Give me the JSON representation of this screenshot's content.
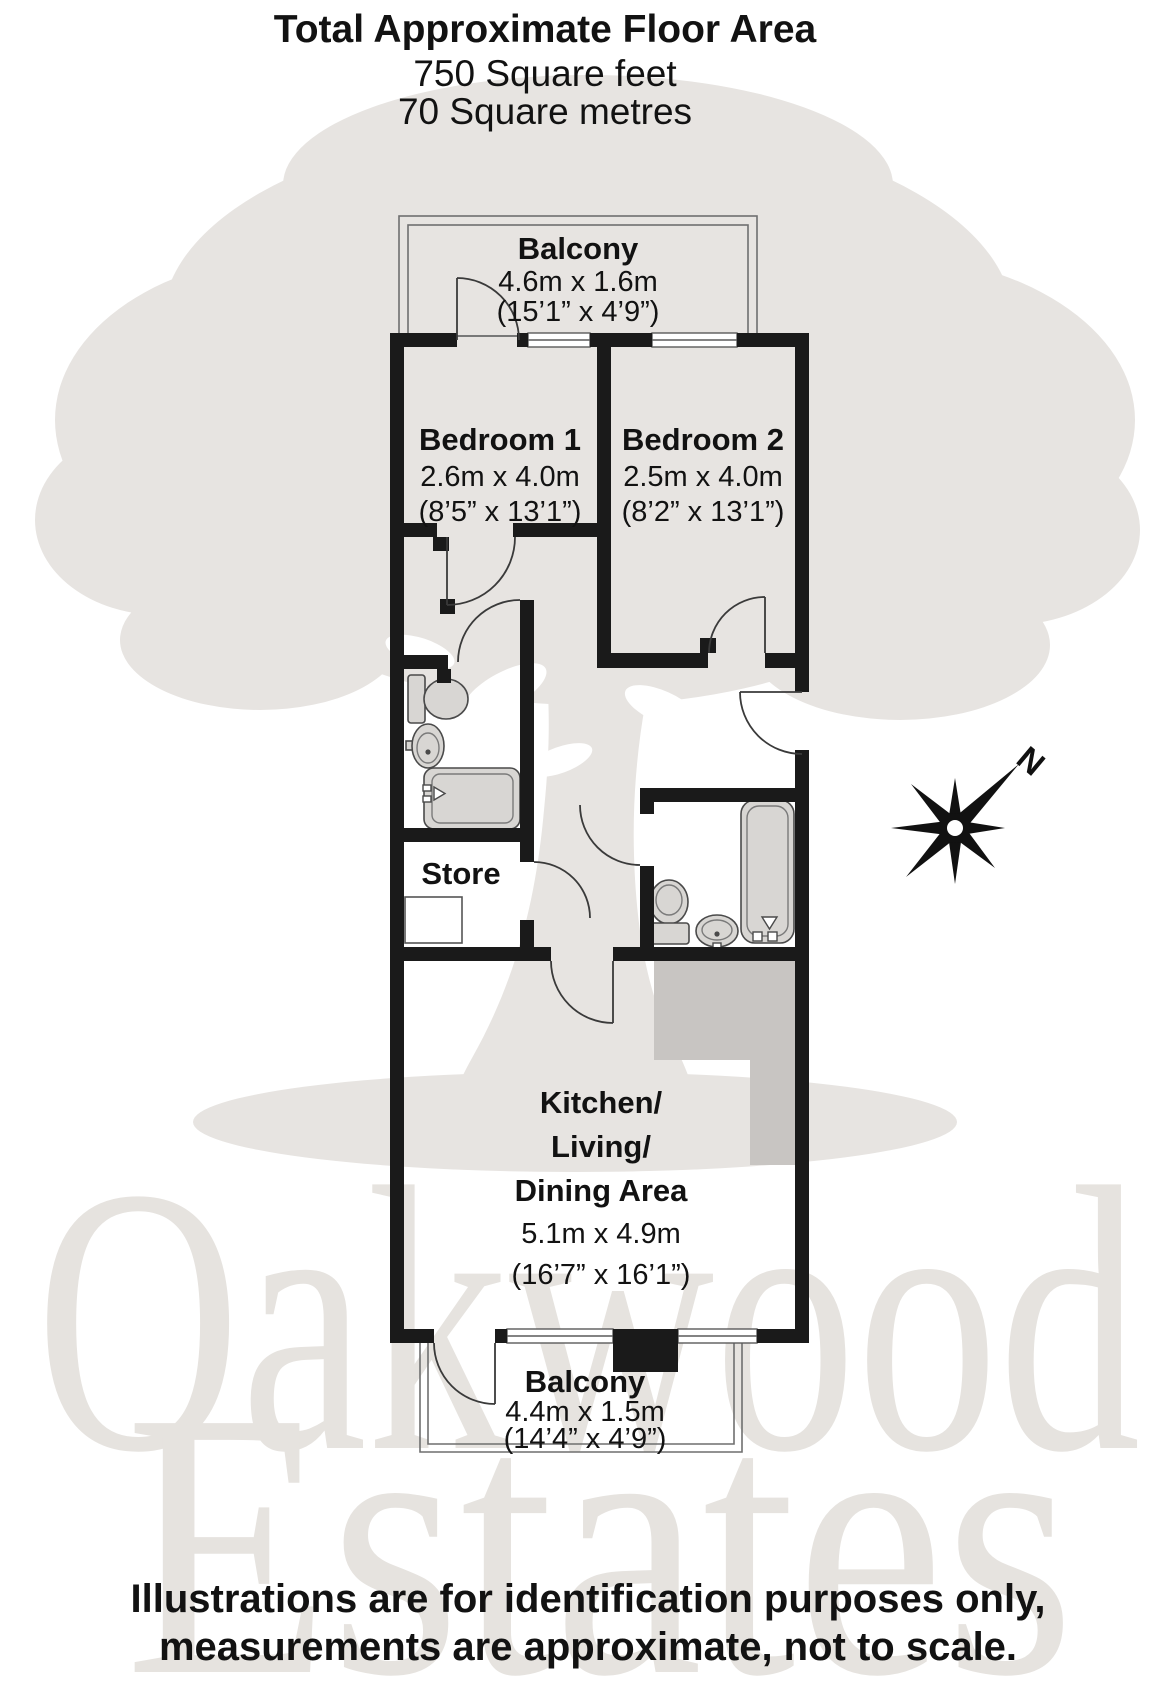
{
  "title": {
    "line1": "Total Approximate Floor Area",
    "line2": "750 Square feet",
    "line3": "70 Square metres"
  },
  "floor_plan": {
    "balcony_top": {
      "name": "Balcony",
      "size_metric": "4.6m x 1.6m",
      "size_imperial": "(15’1” x 4’9”)"
    },
    "bedroom_1": {
      "name": "Bedroom 1",
      "size_metric": "2.6m x 4.0m",
      "size_imperial": "(8’5” x 13’1”)"
    },
    "bedroom_2": {
      "name": "Bedroom 2",
      "size_metric": "2.5m x 4.0m",
      "size_imperial": "(8’2” x 13’1”)"
    },
    "store": {
      "name": "Store"
    },
    "kitchen_living_dining": {
      "name_line1": "Kitchen/",
      "name_line2": "Living/",
      "name_line3": "Dining Area",
      "size_metric": "5.1m x 4.9m",
      "size_imperial": "(16’7” x 16’1”)"
    },
    "balcony_bottom": {
      "name": "Balcony",
      "size_metric": "4.4m x 1.5m",
      "size_imperial": "(14’4” x 4’9”)"
    }
  },
  "compass": {
    "north_label": "N"
  },
  "watermark": {
    "word1": "Oakwood",
    "word2": "Estates"
  },
  "footer": {
    "line1": "Illustrations are for identification purposes only,",
    "line2": "measurements are approximate, not to scale."
  },
  "colors": {
    "wall": "#1a1a1a",
    "watermark_gray": "#e7e4e1",
    "counter_gray": "#c8c5c2",
    "fixture_fill": "#d8d6d3"
  }
}
